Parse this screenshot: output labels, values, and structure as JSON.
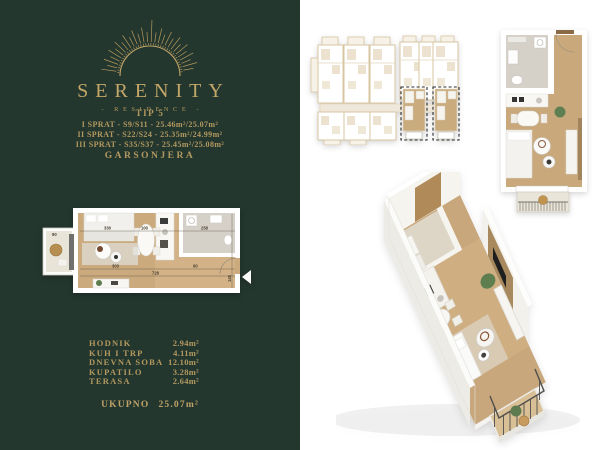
{
  "page": {
    "left_panel_bg": "#24372f",
    "right_panel_bg": "#ffffff",
    "gold": "#bc9f63"
  },
  "brand": {
    "name": "SERENITY",
    "subtitle": "- RESIDENCE -"
  },
  "unit": {
    "type": "TIP 5",
    "floors": [
      "I SPRAT - S9/S11 - 25.46m²/25.07m²",
      "II SPRAT - S22/S24 - 25.35m²/24.99m²",
      "III SPRAT - S35/S37 - 25.45m²/25.08m²"
    ],
    "kind": "GARSONJERA"
  },
  "rooms": [
    {
      "name": "HODNIK",
      "area": "2.94m²"
    },
    {
      "name": "KUH I TRP",
      "area": "4.11m²"
    },
    {
      "name": "DNEVNA SOBA",
      "area": "12.10m²"
    },
    {
      "name": "KUPATILO",
      "area": "3.28m²"
    },
    {
      "name": "TERASA",
      "area": "2.64m²"
    }
  ],
  "total": {
    "label": "UKUPNO",
    "value": "25.07m²"
  },
  "plan2d": {
    "dims_top": [
      "330",
      "100",
      "258"
    ],
    "dims_bottom": [
      "303",
      "728",
      "90"
    ],
    "dim_terrace": "90",
    "dim_right": "145"
  }
}
